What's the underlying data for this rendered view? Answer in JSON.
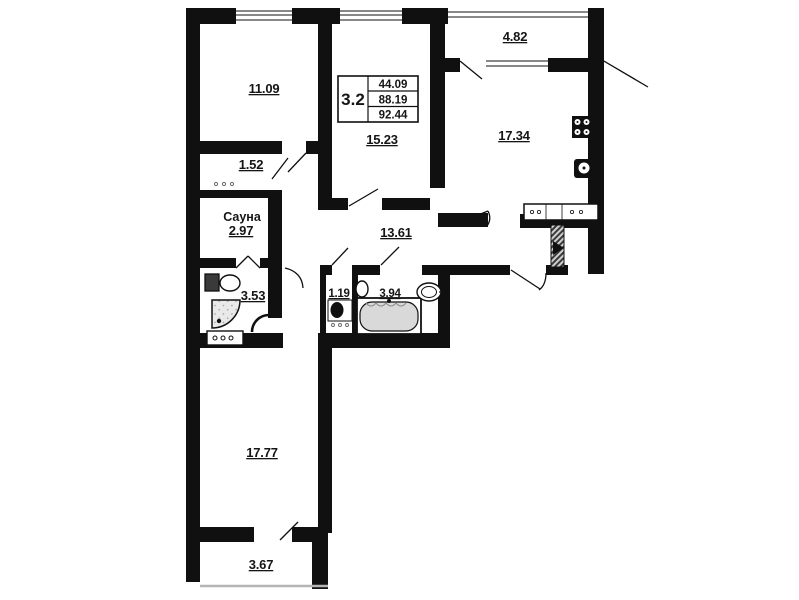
{
  "info_box": {
    "unit_type": "3.2",
    "living_area": "44.09",
    "apartment_area": "88.19",
    "total_area": "92.44"
  },
  "rooms": {
    "bedroom_top_left": {
      "area": "11.09"
    },
    "room_center": {
      "area": "15.23"
    },
    "balcony_top": {
      "area": "4.82"
    },
    "kitchen": {
      "area": "17.34"
    },
    "closet": {
      "area": "1.52"
    },
    "sauna": {
      "name": "Сауна",
      "area": "2.97"
    },
    "shower_room": {
      "area": "3.53"
    },
    "hallway": {
      "area": "13.61"
    },
    "wc": {
      "area": "1.19"
    },
    "bathroom": {
      "area": "3.94"
    },
    "living_room": {
      "area": "17.77"
    },
    "balcony_bottom": {
      "area": "3.67"
    }
  },
  "fixtures": {
    "stove": "stove-icon",
    "kitchen_sink": "kitchen-sink-icon",
    "kitchen_counter": "kitchen-counter-icon",
    "toilet_shower_room": "toilet-icon",
    "corner_shower": "shower-icon",
    "washbasin_shower_room": "washbasin-icon",
    "toilet_wc": "toilet-icon",
    "bathtub": "bathtub-icon",
    "washbasin_bathroom": "washbasin-icon",
    "entrance_door": "entrance-door-icon"
  },
  "colors": {
    "wall": "#101010",
    "paper": "#ffffff",
    "text": "#151515",
    "rail": "#b5b5b5"
  }
}
